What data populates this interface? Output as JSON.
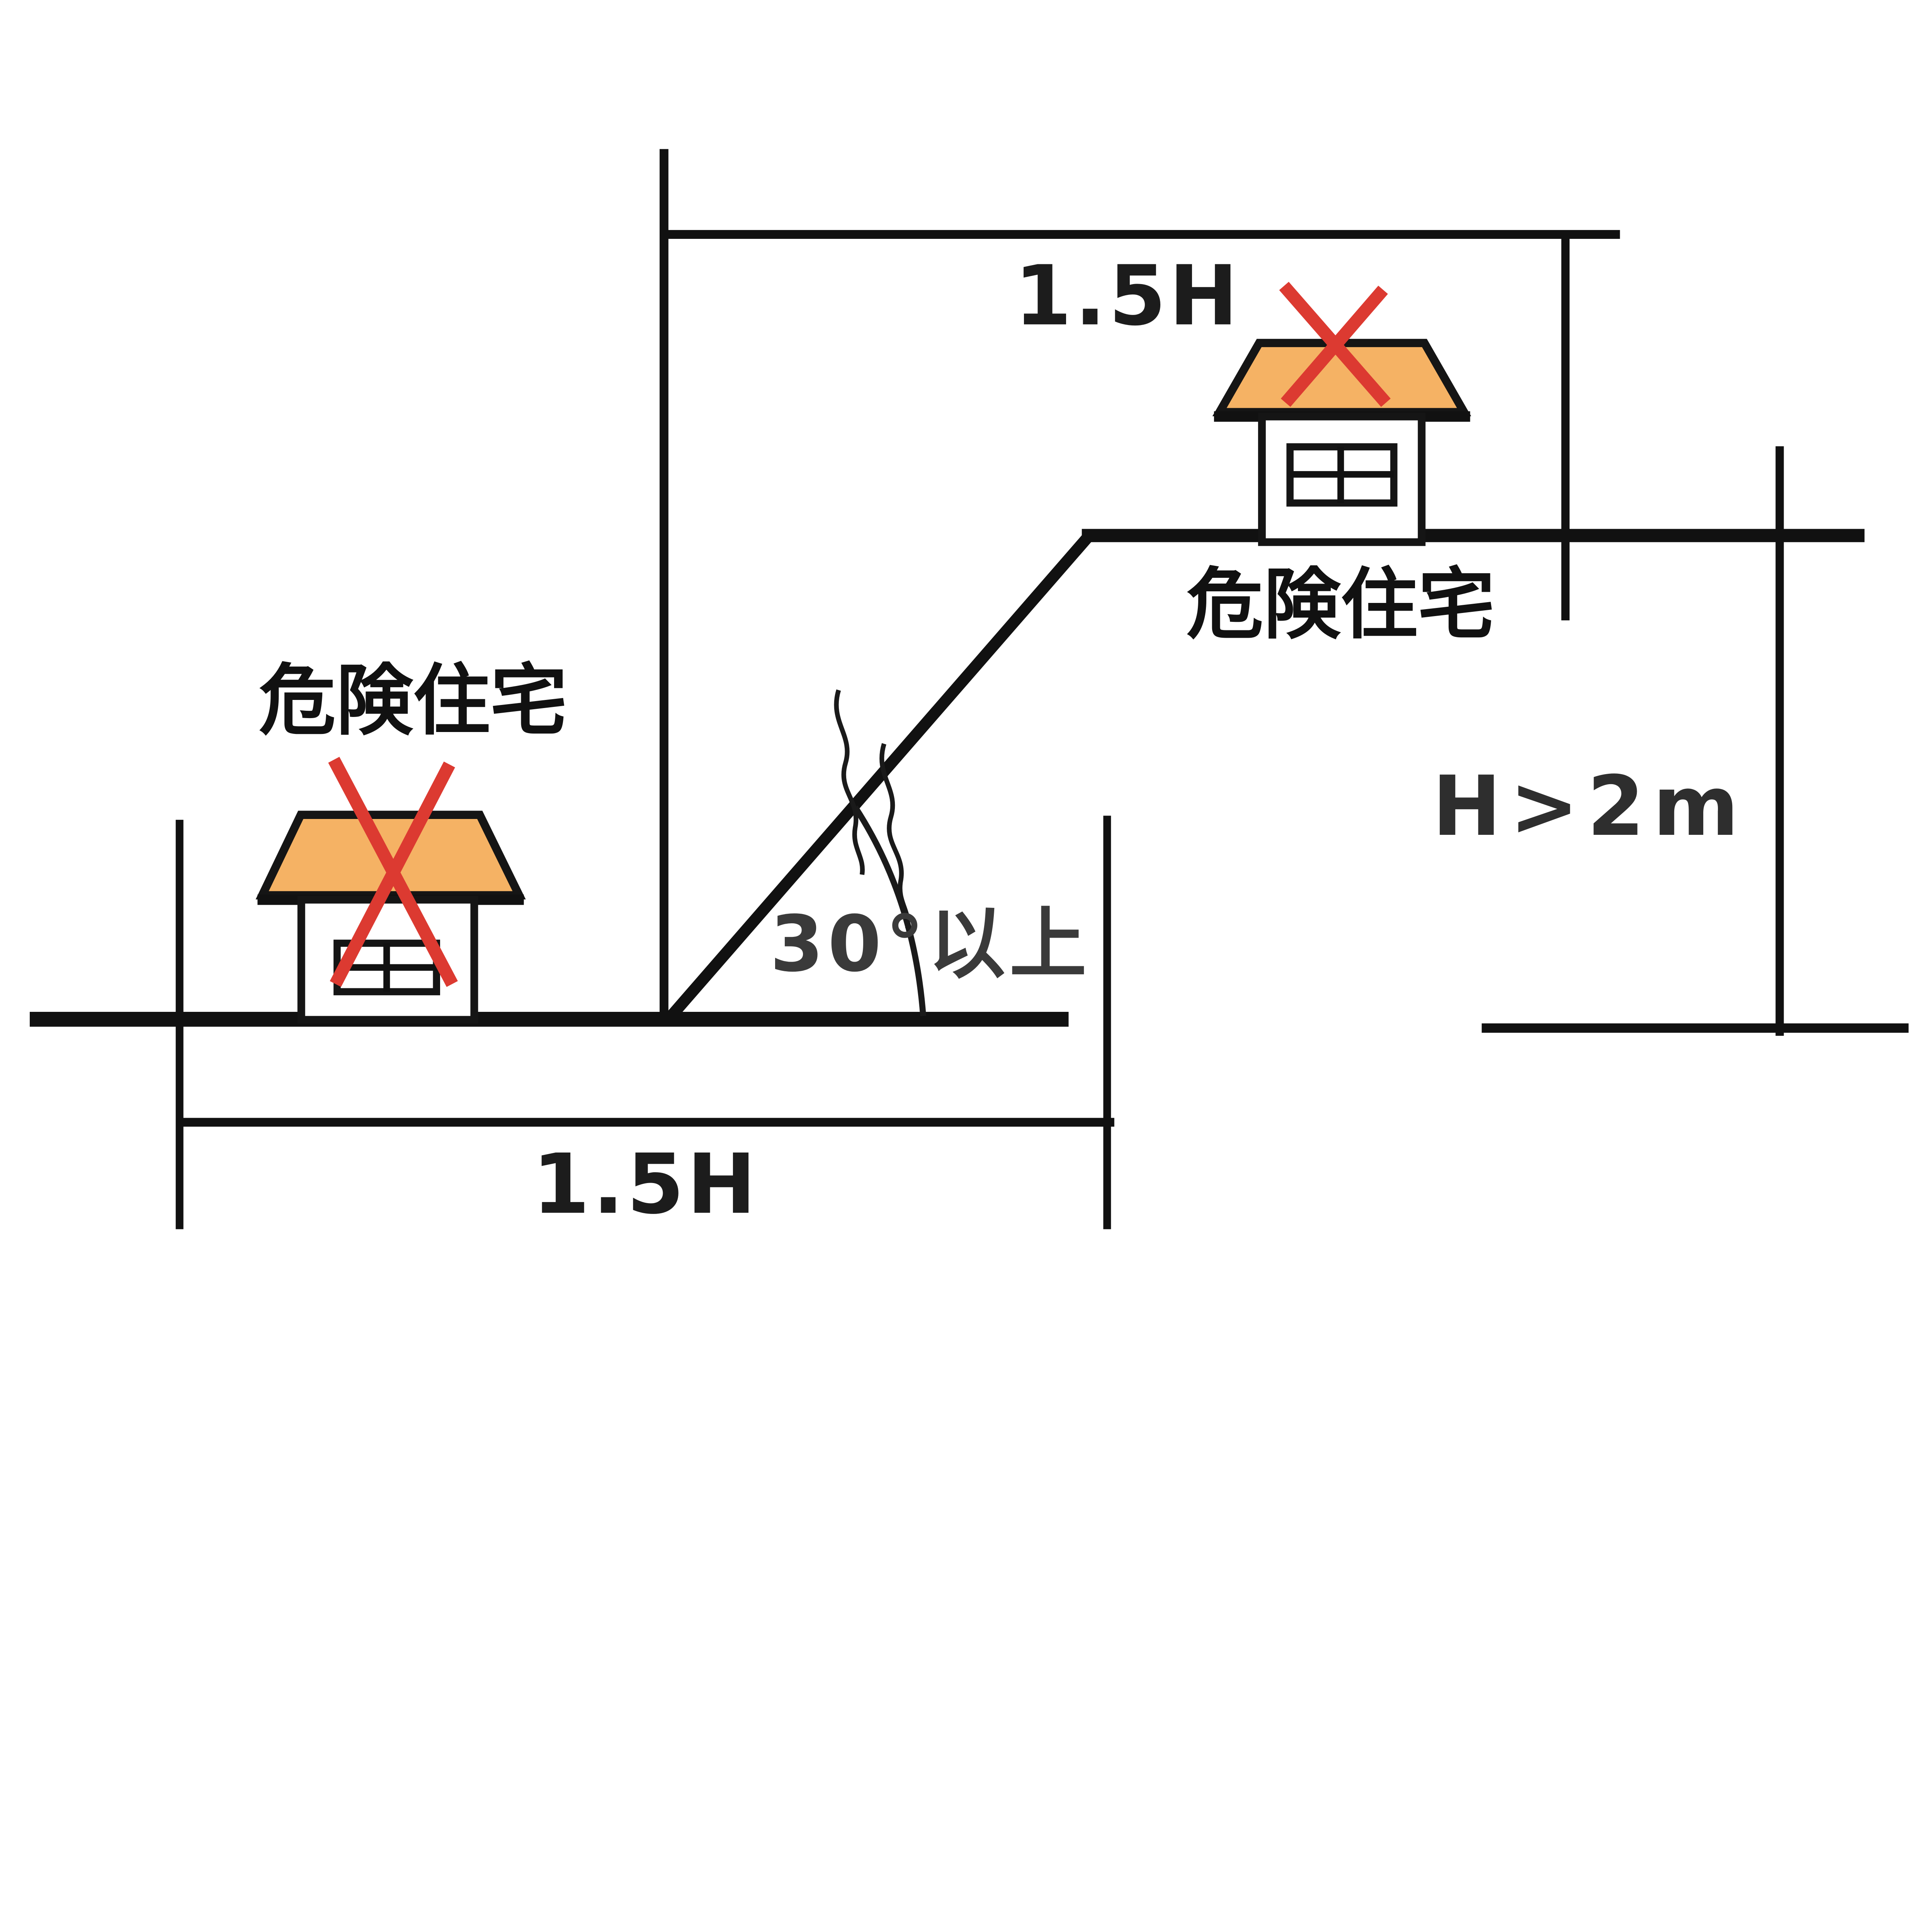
{
  "diagram": {
    "labels": {
      "top_dimension": "1.5H",
      "bottom_dimension": "1.5H",
      "angle_condition": "30°以上",
      "height_condition": "H>2m"
    },
    "houses": [
      {
        "position": "upper",
        "label": "危険住宅"
      },
      {
        "position": "lower",
        "label": "危険住宅"
      }
    ],
    "colors": {
      "roof_fill": "#f5b264",
      "cross_red": "#dc3a31",
      "line_black": "#111111"
    }
  }
}
